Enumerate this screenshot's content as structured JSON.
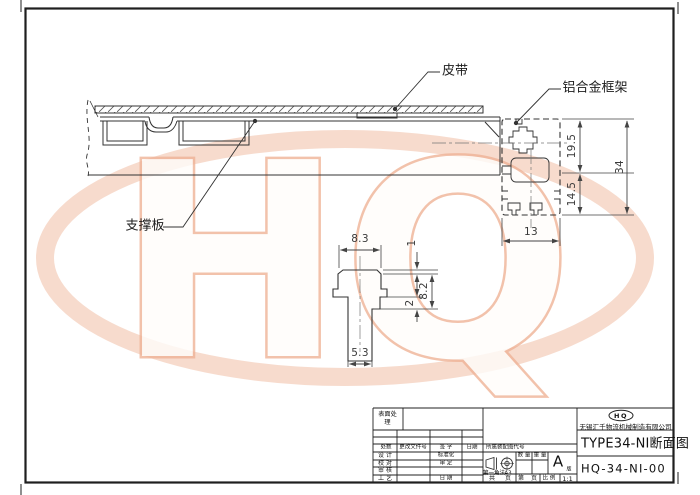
{
  "watermark": {
    "text": "HQ",
    "ring_color": "#f0b79b"
  },
  "callouts": {
    "belt": "皮带",
    "frame": "铝合金框架",
    "support_plate": "支撑板"
  },
  "profile_dims": {
    "upper": "19.5",
    "total": "34",
    "lower": "14.5",
    "width": "13"
  },
  "detail_dims": {
    "top_width": "8.3",
    "lip": "1",
    "head_height": "8.2",
    "groove": "2",
    "stem_width": "5.3"
  },
  "title_block": {
    "surface_treatment": "表面处理",
    "change_row": {
      "count": "处数",
      "doc_no": "更改文件号",
      "sign": "签 字",
      "date": "日期"
    },
    "roles": {
      "design": "设 计",
      "check": "校 对",
      "audit": "审 核",
      "process": "工 艺",
      "standardization": "标准化",
      "approve": "审 定",
      "date": "日 期"
    },
    "assembly_code": "所属装配图代号",
    "projection": {
      "method": "第一角法",
      "sheet": "A3"
    },
    "qty": "数 量",
    "weight": "重 量",
    "version": {
      "letter": "A",
      "suffix": "版"
    },
    "footer": {
      "total": "共",
      "page_unit_a": "页",
      "page": "第",
      "page_unit_b": "页",
      "scale_label": "比 例",
      "scale": "1:1"
    },
    "logo": "HQ",
    "company": "无锡汇千物流机械制造有限公司",
    "title": "TYPE34-NI断面图",
    "number": "HQ-34-NI-00"
  }
}
